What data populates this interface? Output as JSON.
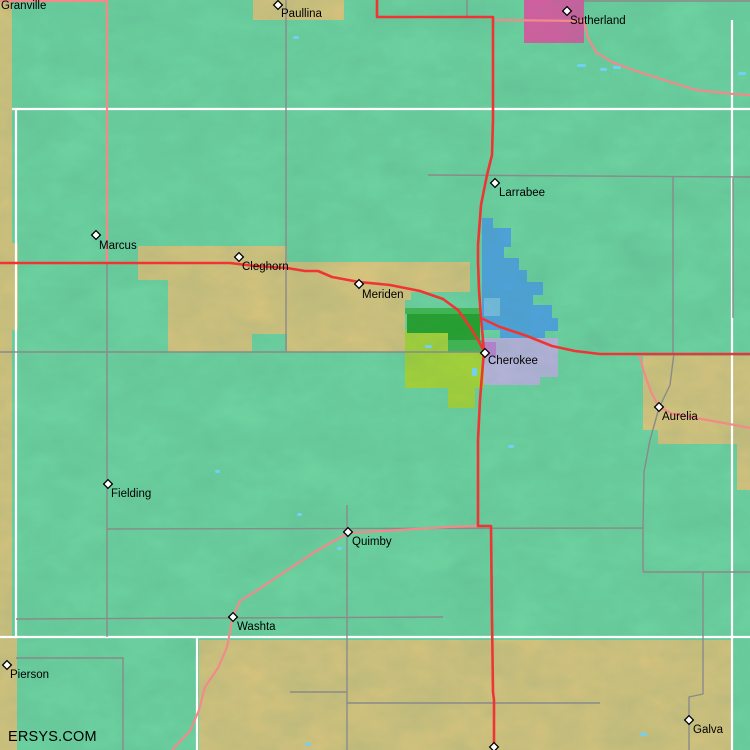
{
  "watermark": "ERSYS.COM",
  "palette": {
    "background": "#72DCA6",
    "tan": "#EACB7E",
    "pink": "#E957A7",
    "blue": "#4FA6EC",
    "light_blue": "#7EC4F4",
    "lavender": "#C8B8EA",
    "orchid": "#D27FE0",
    "dark_green": "#1FA320",
    "mid_green": "#3FBE4A",
    "chartreuse": "#B5DE2E",
    "road_red": "#F03434",
    "road_salmon": "#F28A8A",
    "road_gray": "#8A8A8A",
    "road_white": "#FFFFFF",
    "water": "#6FD1F5",
    "label_color": "#000000"
  },
  "towns": [
    {
      "name": "Granville",
      "marker": null,
      "label_pos": [
        1,
        9
      ]
    },
    {
      "name": "Paullina",
      "marker": [
        278,
        5
      ],
      "label_pos": [
        281,
        17
      ]
    },
    {
      "name": "Sutherland",
      "marker": [
        567,
        11
      ],
      "label_pos": [
        570,
        24
      ]
    },
    {
      "name": "Larrabee",
      "marker": [
        495,
        183
      ],
      "label_pos": [
        499,
        196
      ]
    },
    {
      "name": "Marcus",
      "marker": [
        96,
        235
      ],
      "label_pos": [
        99,
        249
      ]
    },
    {
      "name": "Cleghorn",
      "marker": [
        239,
        257
      ],
      "label_pos": [
        242,
        270
      ]
    },
    {
      "name": "Meriden",
      "marker": [
        359,
        284
      ],
      "label_pos": [
        362,
        298
      ]
    },
    {
      "name": "Cherokee",
      "marker": [
        485,
        353
      ],
      "label_pos": [
        488,
        364
      ]
    },
    {
      "name": "Aurelia",
      "marker": [
        659,
        407
      ],
      "label_pos": [
        662,
        420
      ]
    },
    {
      "name": "Fielding",
      "marker": [
        108,
        484
      ],
      "label_pos": [
        111,
        497
      ]
    },
    {
      "name": "Quimby",
      "marker": [
        348,
        532
      ],
      "label_pos": [
        352,
        545
      ]
    },
    {
      "name": "Washta",
      "marker": [
        233,
        617
      ],
      "label_pos": [
        237,
        630
      ]
    },
    {
      "name": "Pierson",
      "marker": [
        7,
        665
      ],
      "label_pos": [
        10,
        678
      ]
    },
    {
      "name": "Galva",
      "marker": [
        689,
        720
      ],
      "label_pos": [
        693,
        733
      ]
    },
    {
      "name": "",
      "marker": [
        494,
        747
      ],
      "label_pos": null
    }
  ],
  "regions": [
    {
      "name": "left-edge-strip",
      "color": "tan",
      "points": "0,0 12,0 12,243 18,243 18,330 12,330 12,637 17,637 17,750 0,750"
    },
    {
      "name": "paullina-city-box",
      "color": "tan",
      "points": "253,0 344,0 344,20 253,20"
    },
    {
      "name": "cropland-band",
      "color": "tan",
      "points": "138,246 287,246 287,262 470,262 470,292 411,292 411,300 405,300 405,352 287,352 287,334 252,334 252,352 168,352 168,280 138,280"
    },
    {
      "name": "aurelia-area",
      "color": "tan",
      "points": "643,356 750,356 750,444 658,444 658,430 643,430"
    },
    {
      "name": "right-edge-strip",
      "color": "tan",
      "points": "737,444 750,444 750,490 737,490"
    },
    {
      "name": "bottom-band",
      "color": "tan",
      "points": "199,640 733,640 733,750 199,750"
    },
    {
      "name": "sutherland-city-box",
      "color": "pink",
      "points": "524,0 584,0 584,43 524,43"
    },
    {
      "name": "zone-chartreuse",
      "color": "chartreuse",
      "points": "405,330 448,330 448,352 484,352 484,388 475,388 475,408 448,408 448,388 405,388"
    },
    {
      "name": "zone-dark-green",
      "color": "dark_green",
      "points": "407,314 480,314 480,340 448,340 448,333 407,333"
    },
    {
      "name": "zone-mid-green-strip",
      "color": "mid_green",
      "points": "405,308 480,308 480,314 405,314"
    },
    {
      "name": "zone-mid-green-patch",
      "color": "mid_green",
      "points": "448,340 483,340 483,352 448,352"
    },
    {
      "name": "zone-blue",
      "color": "blue",
      "points": "482,218 493,218 493,228 511,228 511,247 504,247 504,258 519,258 519,270 527,270 527,282 543,282 543,295 533,295 533,305 552,305 552,318 558,318 558,331 545,331 545,338 500,338 500,330 482,330"
    },
    {
      "name": "zone-light-blue",
      "color": "light_blue",
      "points": "484,298 500,298 500,316 484,316"
    },
    {
      "name": "zone-lavender",
      "color": "lavender",
      "points": "484,338 558,338 558,377 540,377 540,385 484,385"
    },
    {
      "name": "zone-orchid",
      "color": "orchid",
      "points": "483,342 496,342 496,356 483,356"
    }
  ],
  "roads": [
    {
      "name": "white-road-h-north",
      "color": "road_white",
      "w": 2.2,
      "points": "12,109 750,109"
    },
    {
      "name": "white-road-h-south",
      "color": "road_white",
      "w": 2.2,
      "points": "0,637 750,637"
    },
    {
      "name": "white-road-v-west",
      "color": "road_white",
      "w": 2.2,
      "points": "16,109 16,637"
    },
    {
      "name": "white-road-v-bottom",
      "color": "road_white",
      "w": 2.2,
      "points": "197,637 197,750"
    },
    {
      "name": "white-road-v-east",
      "color": "road_white",
      "w": 2.2,
      "points": "732,20 732,750"
    },
    {
      "name": "gray-road-v-286",
      "color": "road_gray",
      "w": 1.4,
      "points": "286,0 286,352"
    },
    {
      "name": "gray-road-v-107",
      "color": "road_gray",
      "w": 1.4,
      "points": "107,263 107,637"
    },
    {
      "name": "gray-road-h-352",
      "color": "road_gray",
      "w": 1.4,
      "points": "0,352 484,352"
    },
    {
      "name": "gray-road-h-528",
      "color": "road_gray",
      "w": 1.4,
      "points": "107,529 643,528"
    },
    {
      "name": "gray-road-v-quimby",
      "color": "road_gray",
      "w": 1.4,
      "points": "347,505 347,750"
    },
    {
      "name": "gray-road-h-617",
      "color": "road_gray",
      "w": 1.4,
      "points": "16,619 443,617"
    },
    {
      "name": "gray-road-h-658",
      "color": "road_gray",
      "w": 1.4,
      "points": "16,658 123,658 123,750"
    },
    {
      "name": "gray-road-h-692",
      "color": "road_gray",
      "w": 1.4,
      "points": "290,692 347,692"
    },
    {
      "name": "gray-road-h-703",
      "color": "road_gray",
      "w": 1.4,
      "points": "347,703 600,703"
    },
    {
      "name": "gray-road-galva",
      "color": "road_gray",
      "w": 1.4,
      "points": "703,572 703,694 689,697 689,750"
    },
    {
      "name": "gray-road-aurelia",
      "color": "road_gray",
      "w": 1.4,
      "points": "674,353 670,385 659,408 650,440 644,472 643,528 643,572"
    },
    {
      "name": "gray-road-h-572",
      "color": "road_gray",
      "w": 1.4,
      "points": "643,572 750,572"
    },
    {
      "name": "gray-road-h-176",
      "color": "road_gray",
      "w": 1.4,
      "points": "428,175 750,177"
    },
    {
      "name": "gray-road-v-673",
      "color": "road_gray",
      "w": 1.4,
      "points": "673,177 673,353"
    },
    {
      "name": "gray-road-v-733",
      "color": "road_gray",
      "w": 1.4,
      "points": "733,178 733,318"
    },
    {
      "name": "gray-road-v-467",
      "color": "road_gray",
      "w": 1.4,
      "points": "467,0 467,17"
    },
    {
      "name": "gray-road-h-top",
      "color": "road_gray",
      "w": 1.4,
      "points": "584,1 750,1"
    },
    {
      "name": "salmon-road-nw",
      "color": "road_salmon",
      "w": 2.2,
      "points": "0,1 107,1 107,263"
    },
    {
      "name": "salmon-road-sutherland",
      "color": "road_salmon",
      "w": 2.2,
      "points": "495,20 584,21 588,38 596,52 612,62 636,71 664,80 696,90 733,94 750,95"
    },
    {
      "name": "salmon-road-aurelia",
      "color": "road_salmon",
      "w": 2.2,
      "points": "639,354 644,372 651,392 659,407 673,414 696,418 724,423 750,428"
    },
    {
      "name": "salmon-road-washta",
      "color": "road_salmon",
      "w": 2.2,
      "points": "478,526 448,527 400,530 348,533 313,553 283,573 253,593 240,601 233,617 227,647 218,668 205,687 199,710 190,731 172,750"
    },
    {
      "name": "red-hwy-main",
      "color": "road_red",
      "w": 2.6,
      "points": "377,0 377,17 493,17 493,120 492,155 487,175 481,205 478,245 478,262 479,290 481,318 484,351 482,375 480,400 478,440 478,470 478,526 491,526 492,620 493,692 494,700 494,750"
    },
    {
      "name": "red-hwy-west",
      "color": "road_red",
      "w": 2.6,
      "points": "0,263 230,263 255,266 287,268 305,271 318,271 332,277 359,282 390,285 420,291 443,299 458,310 470,327 478,340 484,351"
    },
    {
      "name": "red-hwy-east",
      "color": "road_red",
      "w": 2.6,
      "points": "481,318 500,327 527,336 552,346 575,351 600,354 750,354"
    }
  ],
  "water": [
    [
      293,
      36,
      6,
      3
    ],
    [
      577,
      64,
      9,
      3
    ],
    [
      600,
      68,
      7,
      3
    ],
    [
      613,
      66,
      8,
      3
    ],
    [
      738,
      72,
      8,
      3
    ],
    [
      508,
      445,
      6,
      3
    ],
    [
      215,
      470,
      5,
      3
    ],
    [
      297,
      513,
      5,
      3
    ],
    [
      337,
      547,
      5,
      3
    ],
    [
      425,
      345,
      7,
      3
    ],
    [
      472,
      368,
      5,
      8
    ],
    [
      305,
      743,
      6,
      3
    ],
    [
      640,
      733,
      7,
      3
    ]
  ]
}
